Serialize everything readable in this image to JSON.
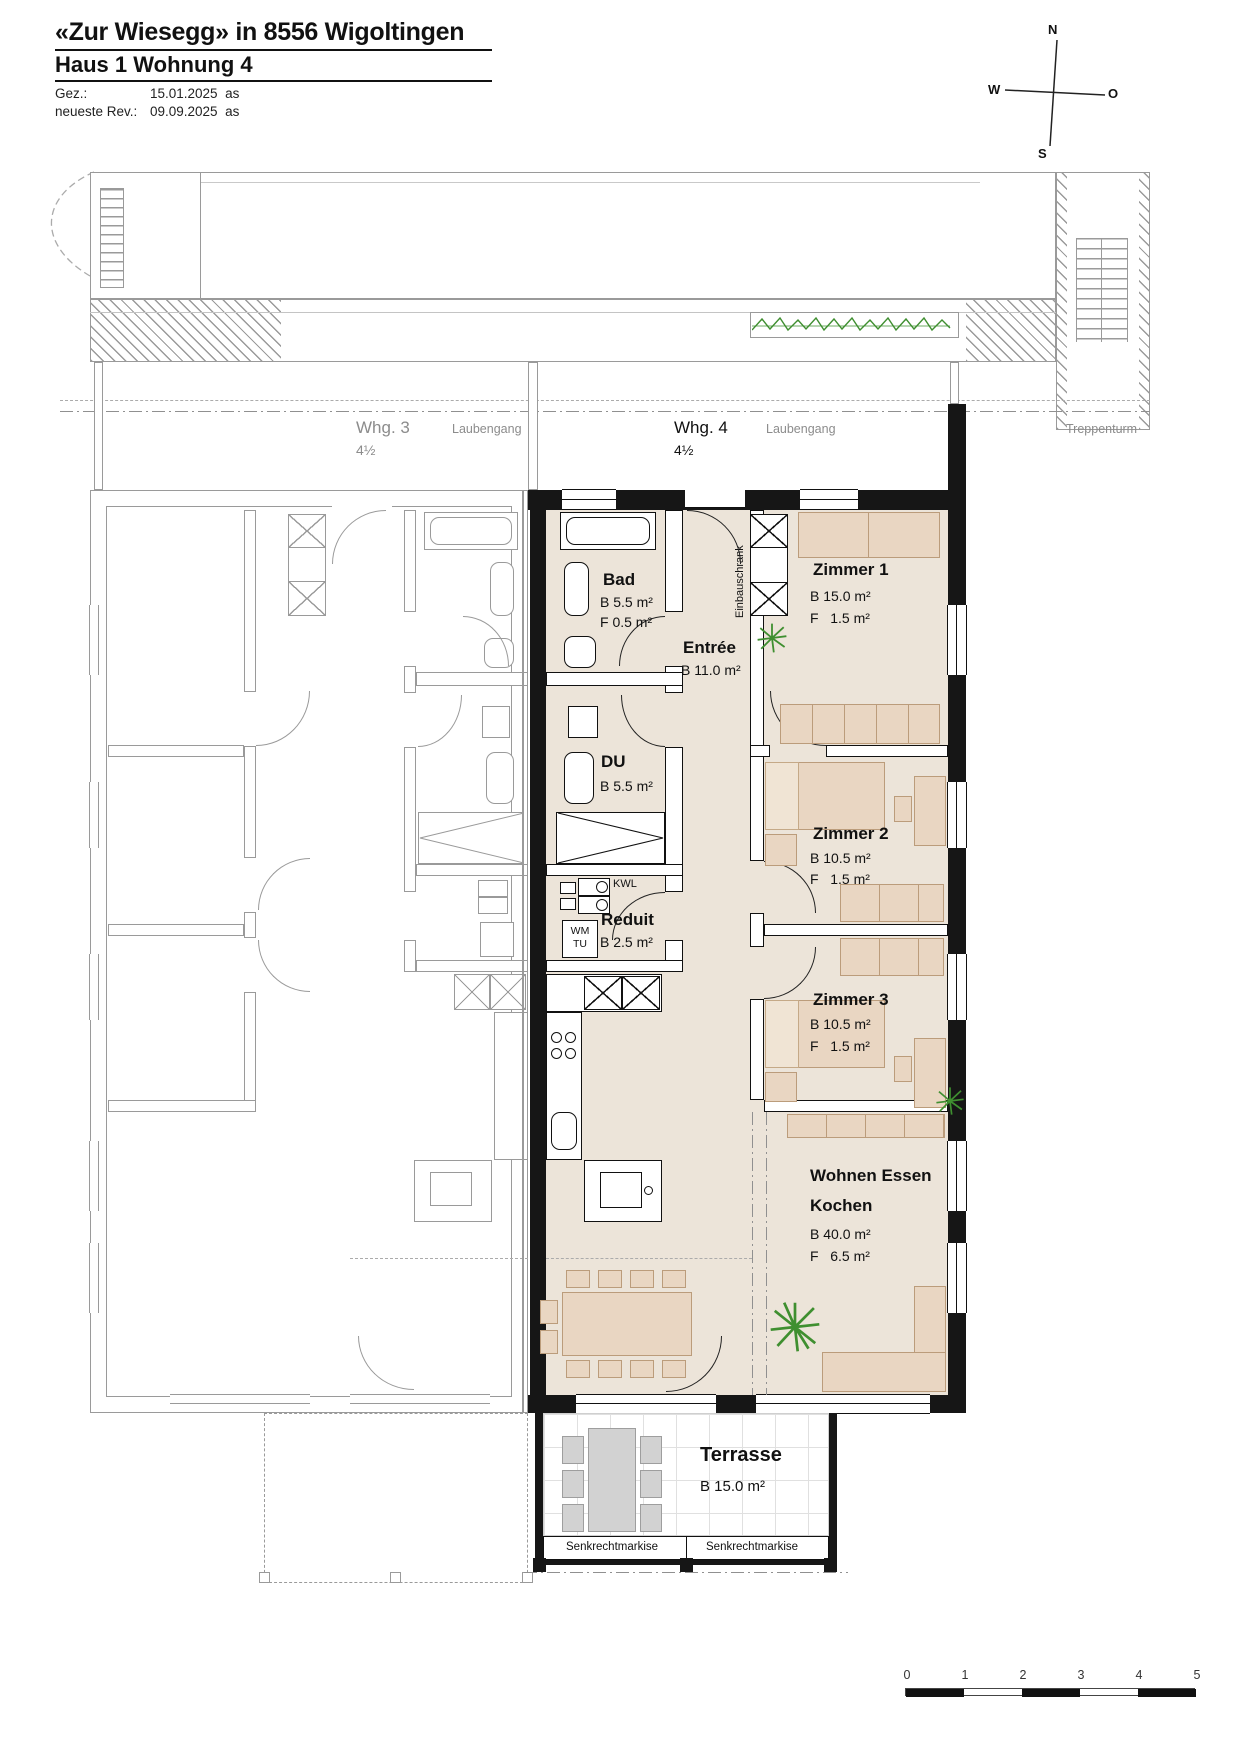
{
  "header": {
    "title": "«Zur Wiesegg» in 8556 Wigoltingen",
    "subtitle": "Haus 1 Wohnung 4",
    "gez_label": "Gez.:",
    "gez_value": "15.01.2025  as",
    "rev_label": "neueste Rev.:",
    "rev_value": "09.09.2025  as"
  },
  "compass": {
    "n": "N",
    "w": "W",
    "o": "O",
    "s": "S"
  },
  "zones": {
    "whg3": "Whg. 3",
    "whg3_size": "4½",
    "laubengang_left": "Laubengang",
    "whg4": "Whg. 4",
    "whg4_size": "4½",
    "laubengang_right": "Laubengang",
    "treppenturm": "Treppenturm"
  },
  "rooms": {
    "bad": {
      "name": "Bad",
      "b": "B 5.5 m²",
      "f": "F 0.5 m²"
    },
    "entree": {
      "name": "Entrée",
      "b": "B 11.0 m²"
    },
    "du": {
      "name": "DU",
      "b": "B 5.5 m²"
    },
    "reduit": {
      "name": "Reduit",
      "b": "B 2.5 m²"
    },
    "kwl": "KWL",
    "wm": "WM",
    "tu": "TU",
    "einbauschrank": "Einbauschrank",
    "zimmer1": {
      "name": "Zimmer 1",
      "b": "B 15.0 m²",
      "f": "F   1.5 m²"
    },
    "zimmer2": {
      "name": "Zimmer 2",
      "b": "B 10.5 m²",
      "f": "F   1.5 m²"
    },
    "zimmer3": {
      "name": "Zimmer 3",
      "b": "B 10.5 m²",
      "f": "F   1.5 m²"
    },
    "wohnen": {
      "name1": "Wohnen Essen",
      "name2": "Kochen",
      "b": "B 40.0 m²",
      "f": "F   6.5 m²"
    },
    "terrasse": {
      "name": "Terrasse",
      "b": "B 15.0 m²"
    }
  },
  "awning": {
    "left": "Senkrechtmarkise",
    "right": "Senkrechtmarkise"
  },
  "scalebar": {
    "labels": [
      "0",
      "1",
      "2",
      "3",
      "4",
      "5"
    ]
  },
  "colors": {
    "floor": "#ece4d9",
    "furniture": "#e9d6c2",
    "furniture_border": "#bb9c7b",
    "wall": "#161616",
    "neighbor_gray": "#9a9a9a",
    "plant_green": "#3f8f30"
  }
}
